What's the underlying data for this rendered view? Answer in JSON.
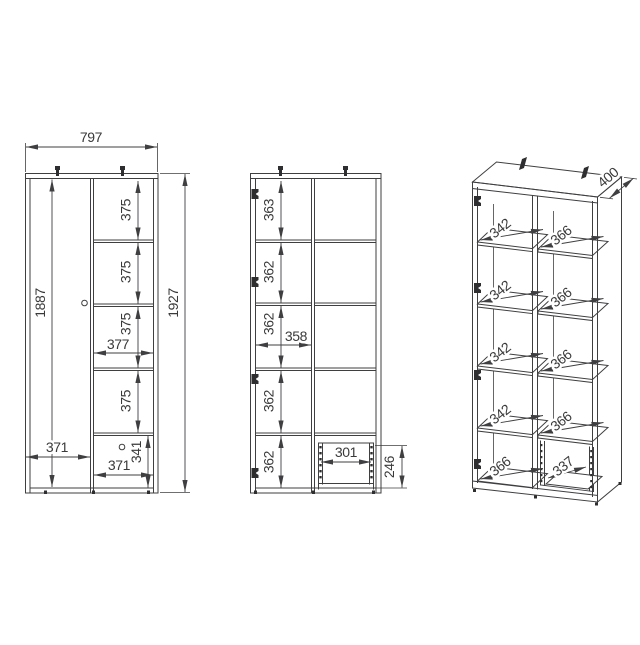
{
  "colors": {
    "line": "#3f3f42",
    "text": "#3a3a3a",
    "background": "#ffffff"
  },
  "views": {
    "front": {
      "width": "797",
      "inner_height": "1887",
      "total_height": "1927",
      "cells": [
        "375",
        "375",
        "375",
        "375"
      ],
      "cell_width": "377",
      "door_width": "371",
      "bottom_door_width": "371",
      "bottom_door_height": "341"
    },
    "interior": {
      "cells": [
        "363",
        "362",
        "362",
        "362",
        "362"
      ],
      "inner_width": "358",
      "drawer_width": "301",
      "drawer_height": "246"
    },
    "perspective": {
      "depth": "400",
      "left_shelves": [
        "342",
        "342",
        "342",
        "342"
      ],
      "bottom_depth": "366",
      "right_shelves": [
        "366",
        "366",
        "366",
        "366"
      ],
      "drawer_depth": "337"
    }
  },
  "icons": {
    "hinge": "hinge-icon",
    "wall_bracket": "wall-bracket-icon",
    "knob": "door-knob-icon",
    "drawer_rail": "drawer-rail-icon",
    "foot": "foot-icon"
  }
}
